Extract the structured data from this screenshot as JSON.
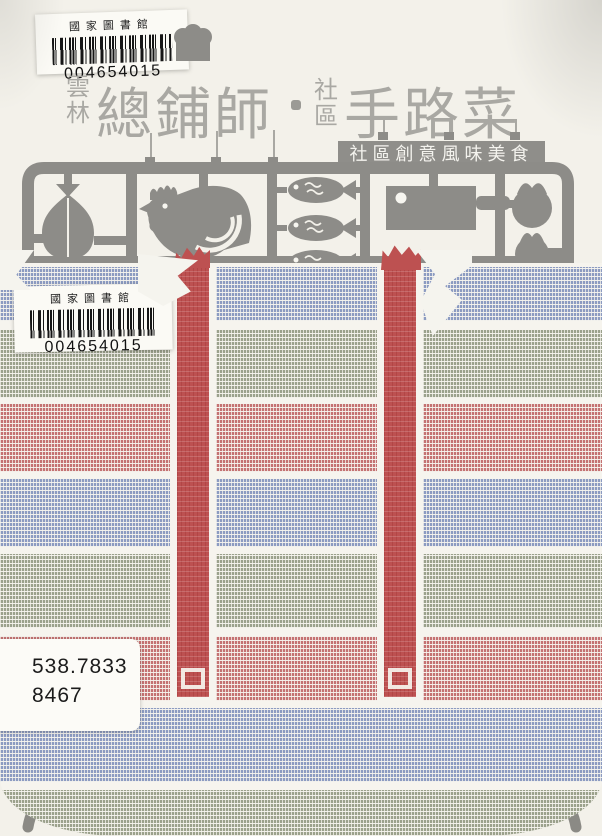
{
  "labels": {
    "top_barcode": {
      "library": "國家圖書館",
      "number": "004654015"
    },
    "bag_barcode": {
      "library": "國家圖書館",
      "number": "004654015"
    },
    "call_number": {
      "line1": "538.7833",
      "line2": "8467"
    }
  },
  "title": {
    "region_top": "雲",
    "region_bottom": "林",
    "main_left": "總鋪師",
    "mid_top": "社",
    "mid_bottom": "區",
    "main_right": "手路菜",
    "subtitle": "社區創意風味美食"
  },
  "icons": {
    "chef_hat": "chef-hat-icon",
    "meat": "meat-cut-icon",
    "rooster": "rooster-icon",
    "fish": "fish-icon",
    "cleaver": "cleaver-icon",
    "tomato": "tomato-icon",
    "wok": "wok-handles-icon",
    "sprue": "model-kit-sprue-frame"
  },
  "colors": {
    "background": "#f3f1ea",
    "stripe_blue": "#8c9bc1",
    "stripe_green": "#9ba18c",
    "stripe_red": "#c47272",
    "strap_red": "#bd5151",
    "gap_white": "#f6f4ee",
    "sprue_gray": "#8d8c88",
    "title_gray": "#a9a8a3",
    "banner_gray": "#8f8e8a"
  },
  "bag": {
    "stripe_order": [
      "blue",
      "green",
      "red",
      "blue",
      "green",
      "red",
      "blue",
      "green"
    ]
  }
}
